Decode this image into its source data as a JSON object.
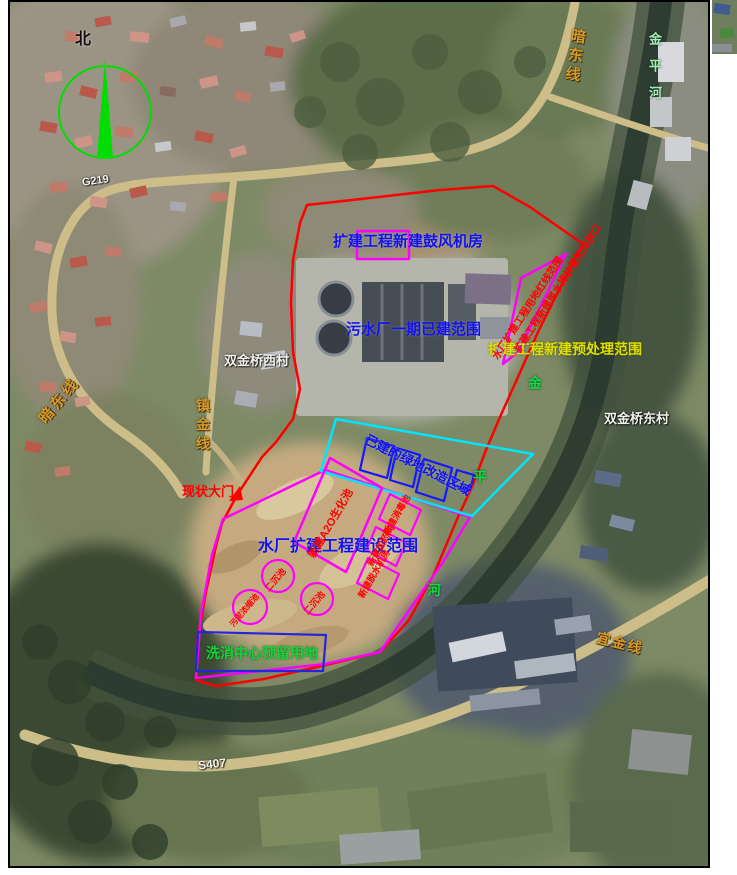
{
  "figure": {
    "compass": {
      "north_label": "北"
    },
    "roads": {
      "g219": "G219",
      "s407": "S407",
      "andong_line_right": "暗东线",
      "andong_line_left": "暗东线",
      "zhenjin_line": "镇金线",
      "yijin_line": "宜金线"
    },
    "places": {
      "village_west": "双金桥西村",
      "village_east": "双金桥东村",
      "river_name": "金平河",
      "river_char_1": "金",
      "river_char_2": "平",
      "river_char_3": "河"
    },
    "annotations": {
      "blower_room": "扩建工程新建鼓风机房",
      "phase1_built": "污水厂一期已建范围",
      "pretreatment_scope": "扩建工程新建预处理范围",
      "redline_text_outer": "扩建工程新建尾水排放管及排放口",
      "redline_text_inner": "水厂扩建工程用地红线范围",
      "renovation_area": "已建的绿地改造区域",
      "construction_scope": "水厂扩建工程建设范围",
      "existing_gate": "现状大门",
      "a2o_tank": "新建A2O生化池",
      "unit_a": "新建消毒池",
      "unit_b": "新建加药间",
      "unit_c": "新建脱水机房",
      "clarifier_1": "二沉池",
      "clarifier_2": "二沉池",
      "sludge_thickener": "污泥浓缩池",
      "reserved_land": "洗消中心预留用地"
    },
    "colors": {
      "boundary_red": "#ff0000",
      "outline_magenta": "#ff00ff",
      "outline_cyan": "#00e4ff",
      "outline_blue": "#1515ff",
      "label_blue": "#1212ee",
      "label_yellow": "#dede00",
      "label_green": "#12d53c",
      "river_label_green": "#0ddb44",
      "road_label_orange": "#d79b2a",
      "compass_green": "#00dd00"
    }
  }
}
